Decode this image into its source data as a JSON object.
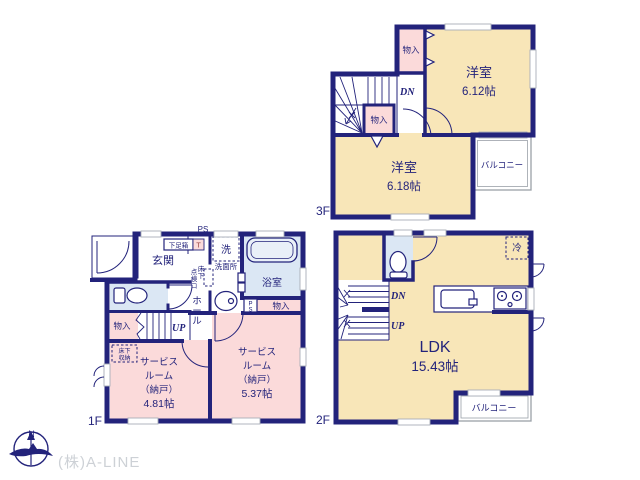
{
  "meta": {
    "type": "real-estate-floor-plan",
    "colors": {
      "wall_navy": "#23237B",
      "room_tan": "#F8E6B8",
      "room_pink": "#FBDADA",
      "fixture_blue": "#DBE7F4",
      "balcony_gray": "#9AA0A8",
      "logo_gray": "#CDD1D6",
      "t_box_letter": "#994444"
    }
  },
  "f3": {
    "floor_label": "3F",
    "room1_name": "洋室",
    "room1_size": "6.12帖",
    "room2_name": "洋室",
    "room2_size": "6.18帖",
    "closet_top": "物入",
    "closet_mid": "物入",
    "stairs_dn": "DN",
    "balcony": "バルコニー"
  },
  "f2": {
    "floor_label": "2F",
    "ldk_name": "LDK",
    "ldk_size": "15.43帖",
    "fridge": "冷",
    "stairs_dn": "DN",
    "stairs_up": "UP",
    "balcony": "バルコニー"
  },
  "f1": {
    "floor_label": "1F",
    "ps_top": "PS",
    "entrance": "玄関",
    "shoe_box": "下足箱",
    "t_box": "T",
    "washer": "洗",
    "washroom": "洗面所",
    "bath": "浴室",
    "hatch_col_left": "点検口",
    "hatch_col_right": "床下",
    "hall": "ホール",
    "closet_stair": "物入",
    "closet_east": "物入",
    "stairs_up": "UP",
    "ps_p": "P",
    "ps_s": "S",
    "underfloor_line1": "床下",
    "underfloor_line2": "収納",
    "sr1": {
      "lines": [
        "サービス",
        "ルーム",
        "（納戸）",
        "4.81帖"
      ]
    },
    "sr2": {
      "lines": [
        "サービス",
        "ルーム",
        "（納戸）",
        "5.37帖"
      ]
    }
  },
  "footer": {
    "north": "N",
    "company": "(株)A-LINE"
  }
}
